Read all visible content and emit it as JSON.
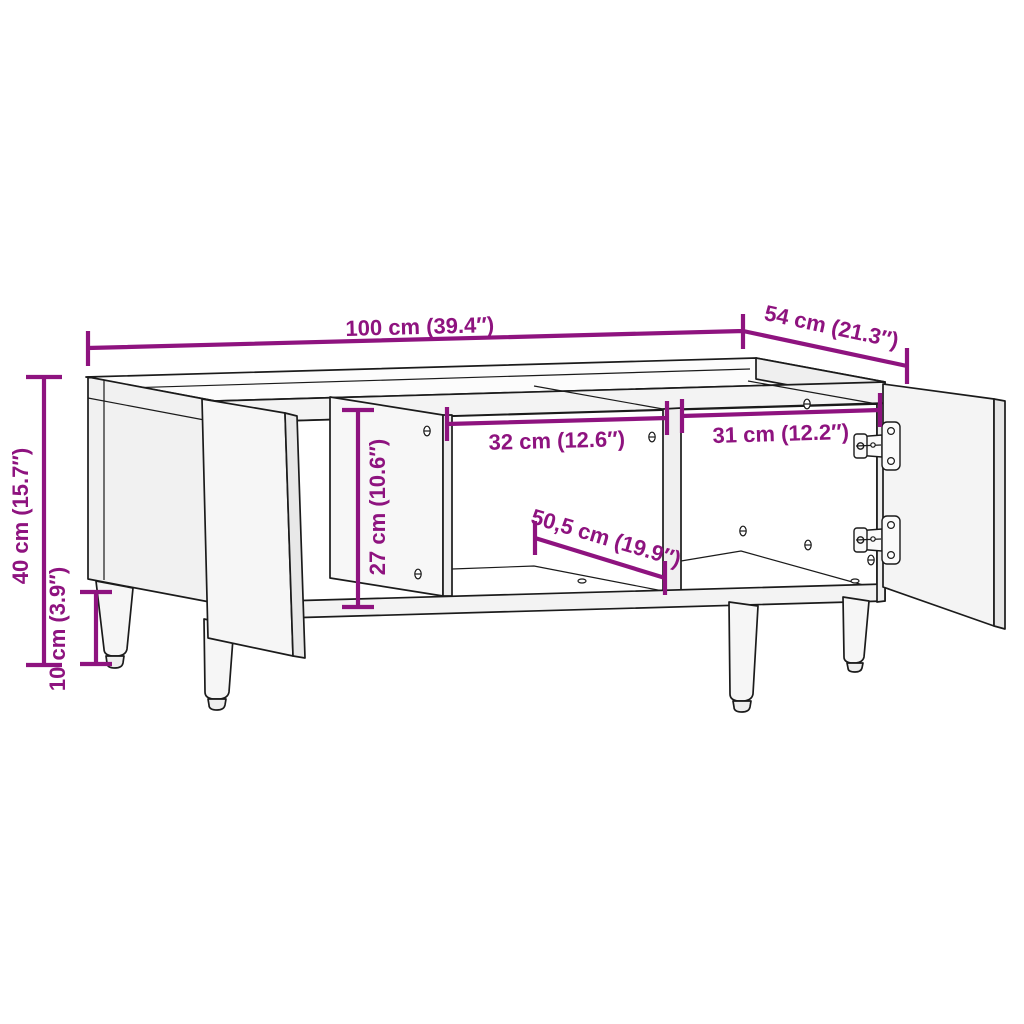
{
  "diagram": {
    "dimensions": {
      "width_top": "100 cm (39.4″)",
      "depth_top": "54 cm (21.3″)",
      "height_total": "40 cm (15.7″)",
      "leg_height": "10 cm (3.9″)",
      "inner_height": "27 cm (10.6″)",
      "inner_width_middle": "32 cm (12.6″)",
      "inner_width_right": "31 cm (12.2″)",
      "inner_depth": "50,5 cm (19.9″)"
    },
    "colors": {
      "accent": "#8E137F",
      "ink": "#1B1B1B",
      "bg": "#FFFFFF"
    }
  }
}
